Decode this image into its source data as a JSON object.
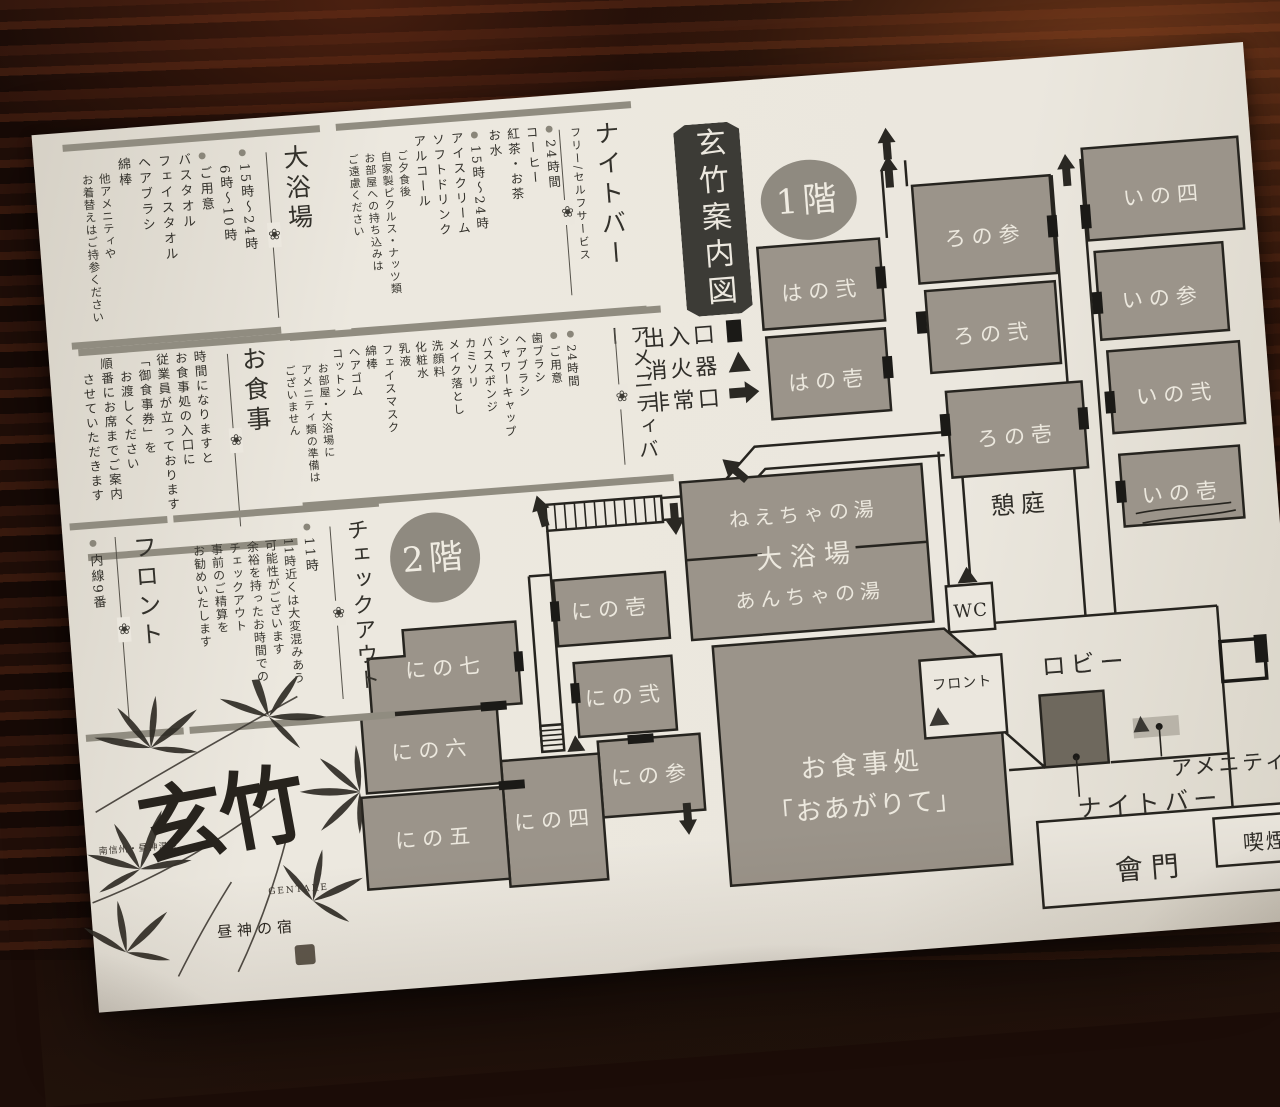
{
  "title": {
    "text": "玄竹案内図"
  },
  "glyphs": {
    "bullet": "●",
    "ornament": "❀"
  },
  "info_boxes": {
    "bath": {
      "heading": "大浴場",
      "hours": "15時〜24時\n　6時〜10時",
      "prep": "ご用意\nバスタオル\nフェイスタオル\nヘアブラシ\n綿棒",
      "note": "他アメニティや\nお着替えはご持参ください"
    },
    "night_bar": {
      "heading": "ナイトバー",
      "subheading": "フリー/セルフサービス",
      "always": "24時間\nコーヒー\n紅茶・お茶\nお水",
      "evening": "15時〜24時\nアイスクリーム\nソフトドリンク\nアルコール",
      "dinner_note": "ご夕食後\n自家製ピクルス・ナッツ類",
      "takeout_note": "お部屋への持ち込みは\nご遠慮ください"
    },
    "amenity_bar": {
      "heading": "アメニティバー",
      "always": "24時間",
      "prep": "ご用意\n歯ブラシ\nヘアブラシ\nシャワーキャップ\nバススポンジ\nカミソリ\nメイク落とし\n洗顔料\n化粧水\n乳液\nフェイスマスク\n綿棒\nヘアゴム\nコットン",
      "note": "お部屋・大浴場に\nアメニティ類の準備は\nございません"
    },
    "meal": {
      "heading": "お食事",
      "body": "時間になりますと\nお食事処の入口に\n従業員が立っております\n「御食事券」を\n　お渡しください\n順番にお席までご案内\n　させていただきます"
    },
    "checkout": {
      "heading": "チェックアウト",
      "time": "11時",
      "note": "11時近くは大変混みあう\n可能性がございます\n余裕を持ったお時間での\nチェックアウト\n事前のご精算を\nお勧めいたします"
    },
    "front_desk": {
      "heading": "フロント",
      "extension": "内線9番"
    }
  },
  "legend": {
    "entrance": "出入口",
    "extinguisher": "消火器",
    "emergency_exit": "非常口"
  },
  "floor1": {
    "badge": "1階",
    "rooms": [
      "はの弐",
      "はの壱",
      "ろの参",
      "ろの弐",
      "ろの壱",
      "いの四",
      "いの参",
      "いの弐",
      "いの壱"
    ],
    "bath": {
      "top": "ねえちゃの湯",
      "middle": "大浴場",
      "bottom": "あんちゃの湯"
    },
    "garden": "憩庭",
    "wc": "WC",
    "lobby": "ロビー",
    "front": "フロント",
    "dining_line1": "お食事処",
    "dining_line2": "「おあがりて」",
    "night_bar": "ナイトバー",
    "amenity_bar": "アメニティバー",
    "gate": "會門",
    "smoking": "喫煙所"
  },
  "floor2": {
    "badge": "2階",
    "rooms": [
      "にの壱",
      "にの弐",
      "にの参",
      "にの四",
      "にの五",
      "にの六",
      "にの七"
    ]
  },
  "logo": {
    "name": "玄竹",
    "romaji": "GENTAKE",
    "tagline": "昼神の宿",
    "region": "南信州・昼神温泉"
  },
  "colors": {
    "paper": "#ebe7de",
    "ink": "#26241f",
    "room_fill": "#9b948a",
    "dark_box": "#6e685d",
    "badge": "#8f8a80",
    "bar": "#908c80",
    "wood": "#200e08"
  }
}
